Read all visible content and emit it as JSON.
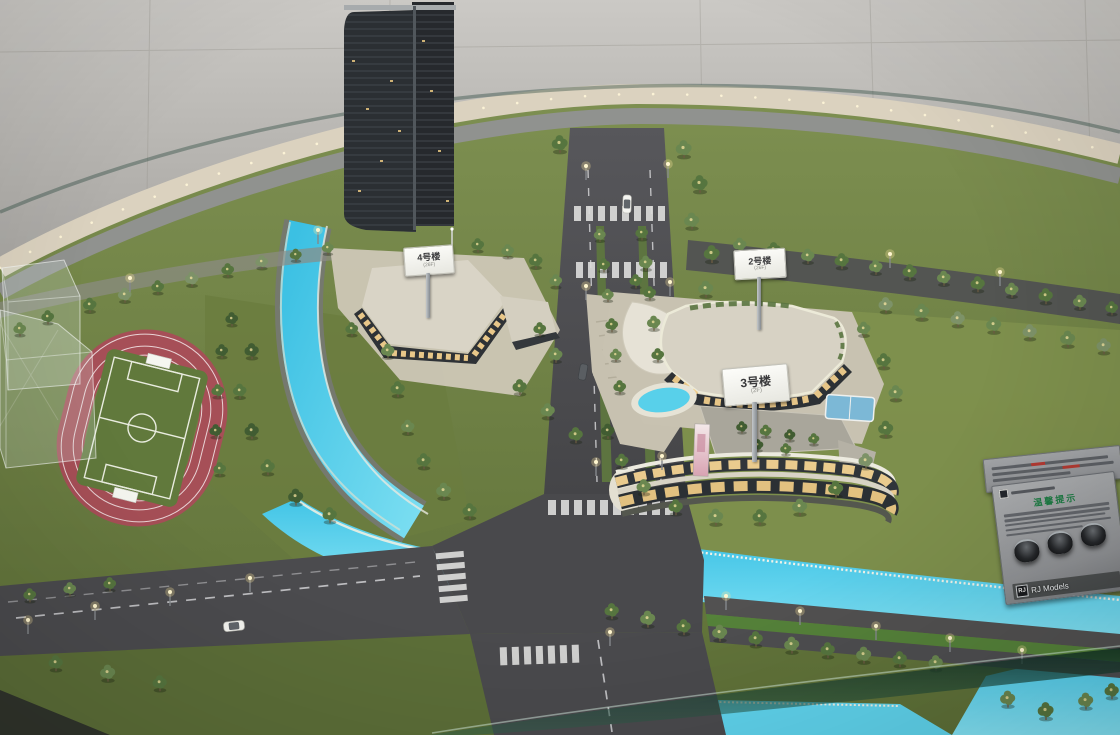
{
  "signs": {
    "building4": {
      "label": "4号楼",
      "sub": "(26F)"
    },
    "building2": {
      "label": "2号楼",
      "sub": "(26F)"
    },
    "building3": {
      "label": "3号楼",
      "sub": "(2F)"
    }
  },
  "plaque": {
    "title": "温馨提示",
    "brand_mark": "RJ",
    "brand_name": "RJ Models"
  },
  "colors": {
    "water": "#4cc9e8",
    "grass": "#75874a",
    "road": "#4a4a4c",
    "track": "#a65058",
    "rim": "#dbd2bf",
    "tree_light": "#ffe9a2",
    "notice_green": "#1d7a43"
  }
}
